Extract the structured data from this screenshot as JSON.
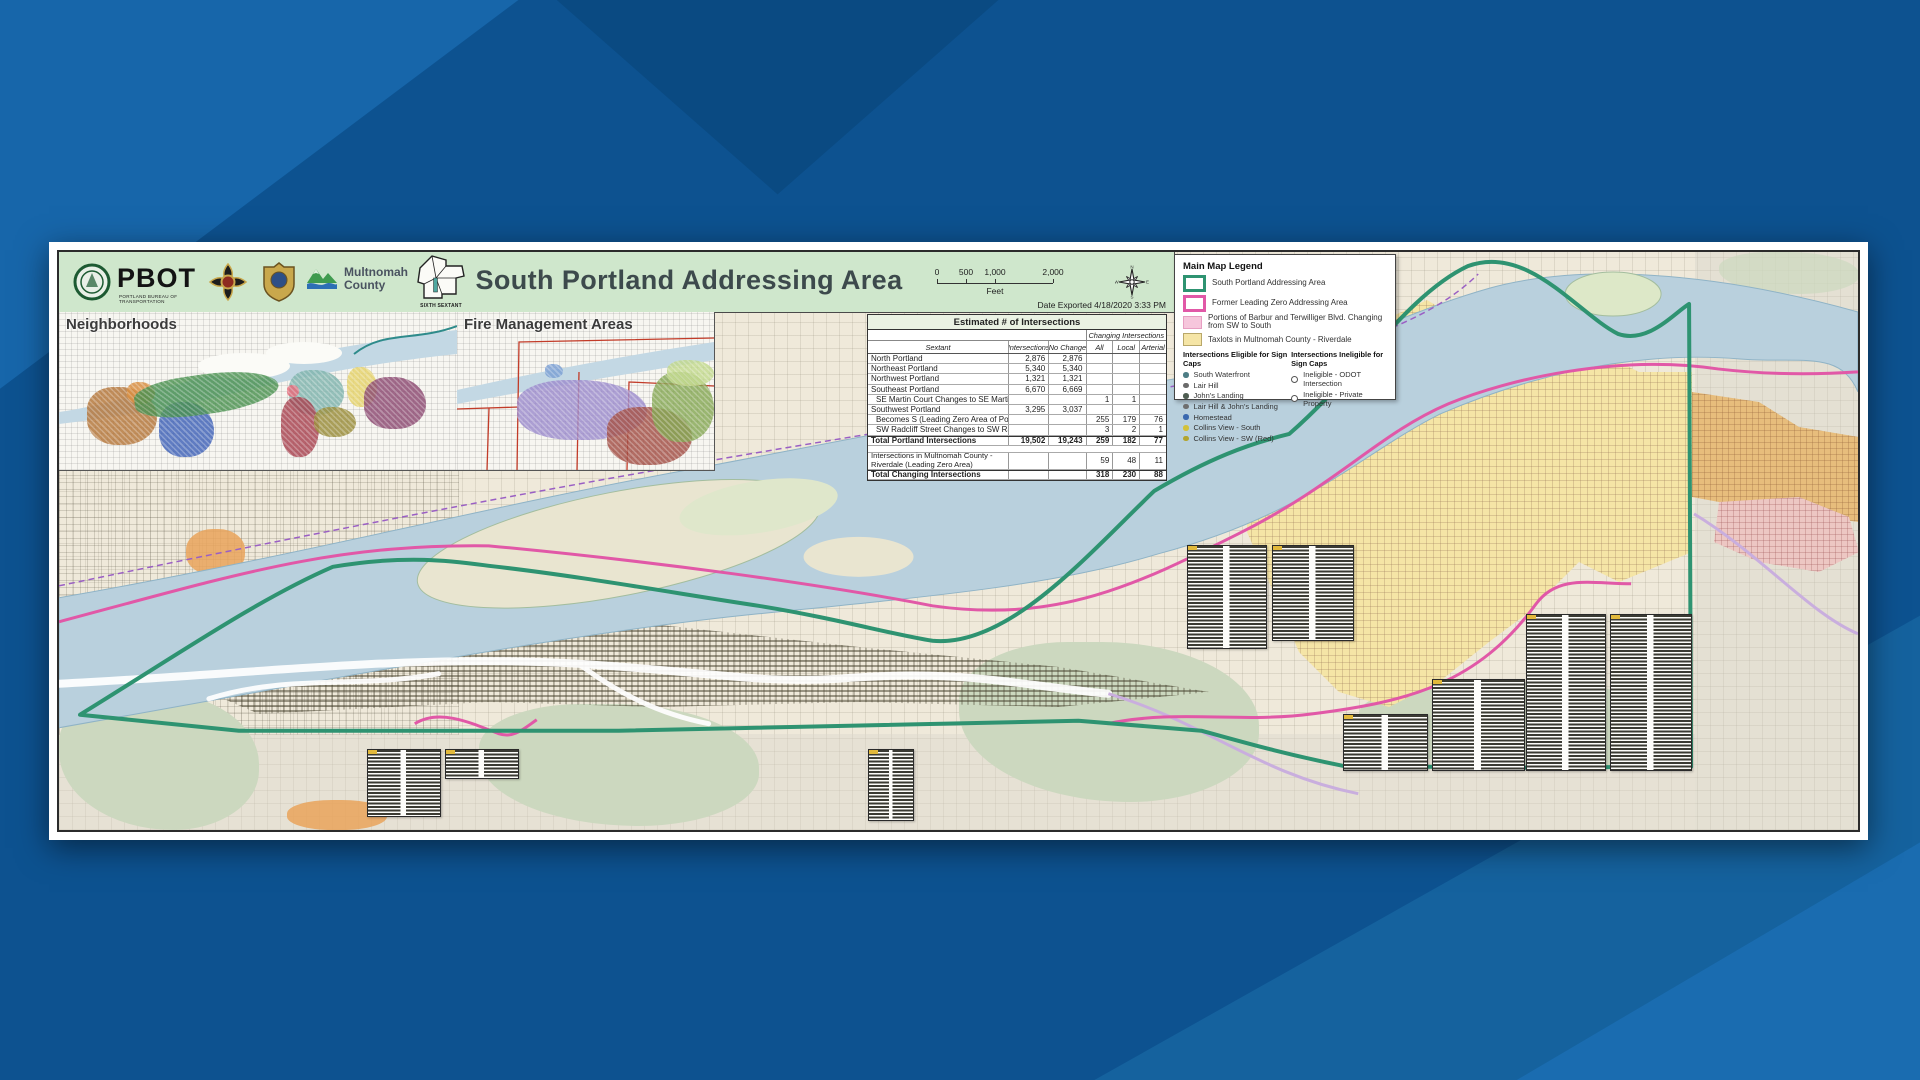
{
  "header": {
    "pbot": "PBOT",
    "pbot_sub": "PORTLAND BUREAU OF TRANSPORTATION",
    "multnomah_line1": "Multnomah",
    "multnomah_line2": "County",
    "sextant_caption": "SIXTH SEXTANT",
    "title": "South Portland Addressing Area",
    "scale": {
      "ticks": [
        "0",
        "500",
        "1,000",
        "2,000"
      ],
      "unit": "Feet"
    },
    "date_exported": "Date Exported 4/18/2020 3:33 PM",
    "compass": [
      "N",
      "E",
      "S",
      "W"
    ]
  },
  "insets": {
    "neighborhoods_title": "Neighborhoods",
    "fire_title": "Fire Management Areas"
  },
  "intersections_table": {
    "title": "Estimated # of Intersections",
    "changing_header": "Changing Intersections",
    "columns": [
      "Sextant",
      "Intersections",
      "No Change",
      "All",
      "Local",
      "Arterial"
    ],
    "rows": [
      {
        "label": "North Portland",
        "values": [
          "2,876",
          "2,876",
          "",
          "",
          ""
        ]
      },
      {
        "label": "Northeast Portland",
        "values": [
          "5,340",
          "5,340",
          "",
          "",
          ""
        ]
      },
      {
        "label": "Northwest Portland",
        "values": [
          "1,321",
          "1,321",
          "",
          "",
          ""
        ]
      },
      {
        "label": "Southeast Portland",
        "values": [
          "6,670",
          "6,669",
          "",
          "",
          ""
        ]
      },
      {
        "label": "SE Martin Court Changes to SE Martins Court",
        "indent": true,
        "values": [
          "",
          "",
          "1",
          "1",
          ""
        ]
      },
      {
        "label": "Southwest Portland",
        "values": [
          "3,295",
          "3,037",
          "",
          "",
          ""
        ]
      },
      {
        "label": "Becomes S (Leading Zero Area of Portland)",
        "indent": true,
        "values": [
          "",
          "",
          "255",
          "179",
          "76"
        ]
      },
      {
        "label": "SW Radcliff Street Changes to SW Radcliffe Street",
        "indent": true,
        "values": [
          "",
          "",
          "3",
          "2",
          "1"
        ]
      },
      {
        "label": "Total Portland Intersections",
        "bold": true,
        "values": [
          "19,502",
          "19,243",
          "259",
          "182",
          "77"
        ]
      },
      {
        "spacer": true
      },
      {
        "label": "Intersections in Multnomah County - Riverdale (Leading Zero Area)",
        "tall": true,
        "values": [
          "",
          "",
          "59",
          "48",
          "11"
        ]
      },
      {
        "label": "Total Changing Intersections",
        "bold": true,
        "values": [
          "",
          "",
          "318",
          "230",
          "88"
        ]
      }
    ]
  },
  "legend": {
    "title": "Main Map Legend",
    "areas": [
      {
        "label": "South Portland Addressing Area",
        "swatch": "green-outline",
        "color": "#2e9371"
      },
      {
        "label": "Former Leading Zero Addressing Area",
        "swatch": "pink-outline",
        "color": "#e158a7"
      },
      {
        "label": "Portions of Barbur and Terwilliger Blvd. Changing from SW to South",
        "swatch": "pink-fill",
        "color": "#f6c6dc"
      },
      {
        "label": "Taxlots in Multnomah County - Riverdale",
        "swatch": "yellow-fill",
        "color": "#f5e5a6"
      }
    ],
    "eligible": {
      "header": "Intersections Eligible for Sign Caps",
      "items": [
        {
          "label": "South Waterfront",
          "color": "#4d7d85"
        },
        {
          "label": "Lair Hill",
          "color": "#6b6b6b"
        },
        {
          "label": "John's Landing",
          "color": "#4f5e52"
        },
        {
          "label": "Lair Hill & John's Landing",
          "color": "#6f6f6f"
        },
        {
          "label": "Homestead",
          "color": "#3b69af"
        },
        {
          "label": "Collins View - South",
          "color": "#d3c139"
        },
        {
          "label": "Collins View - SW (Red)",
          "color": "#b3a52f"
        }
      ]
    },
    "ineligible": {
      "header": "Intersections Ineligible for Sign Caps",
      "items": [
        {
          "label": "Ineligible - ODOT Intersection"
        },
        {
          "label": "Ineligible - Private Property"
        }
      ]
    }
  },
  "map_colors": {
    "river": "#b9d0dd",
    "land": "#efe9da",
    "park": "#ccd8bf",
    "boundary_green": "#2e9371",
    "boundary_pink": "#e158a7",
    "riverdale_yellow": "#f5e5a6",
    "header_band": "#cfe7cc",
    "desktop_blue": "#0d5290"
  }
}
